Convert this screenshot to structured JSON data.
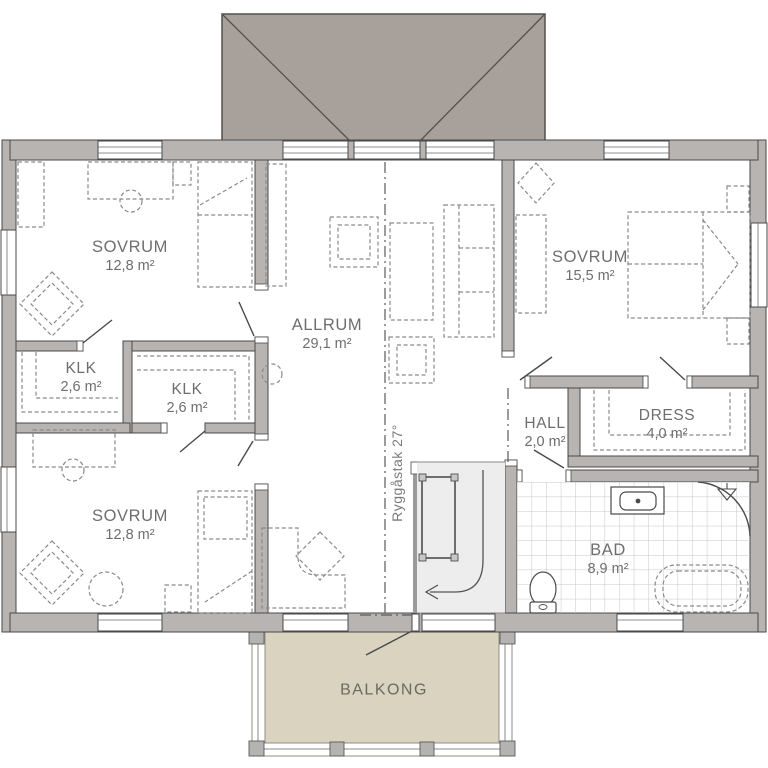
{
  "plan": {
    "type": "floor-plan",
    "floor": "upper-floor",
    "rooms": [
      {
        "id": "sovrum-nw",
        "name": "SOVRUM",
        "area": "12,8 m²"
      },
      {
        "id": "allrum",
        "name": "ALLRUM",
        "area": "29,1 m²"
      },
      {
        "id": "sovrum-e",
        "name": "SOVRUM",
        "area": "15,5 m²"
      },
      {
        "id": "klk-west",
        "name": "KLK",
        "area": "2,6 m²"
      },
      {
        "id": "klk-center",
        "name": "KLK",
        "area": "2,6 m²"
      },
      {
        "id": "sovrum-sw",
        "name": "SOVRUM",
        "area": "12,8 m²"
      },
      {
        "id": "hall",
        "name": "HALL",
        "area": "2,0 m²"
      },
      {
        "id": "dress",
        "name": "DRESS",
        "area": "4,0 m²"
      },
      {
        "id": "bad",
        "name": "BAD",
        "area": "8,9 m²"
      },
      {
        "id": "balkong",
        "name": "BALKONG",
        "area": ""
      }
    ],
    "annotations": {
      "ridge": "Ryggåstak 27°"
    },
    "colors": {
      "roof": "#a8a19b",
      "wall": "#b7b4b2",
      "wall_outline": "#4a4a4a",
      "balcony_deck": "#d9d3c0",
      "stair_fill": "#ededed",
      "tile_line": "#c6c6c6",
      "furniture_dash": "#8a8a8a",
      "label_text": "#6e6e6e"
    }
  }
}
